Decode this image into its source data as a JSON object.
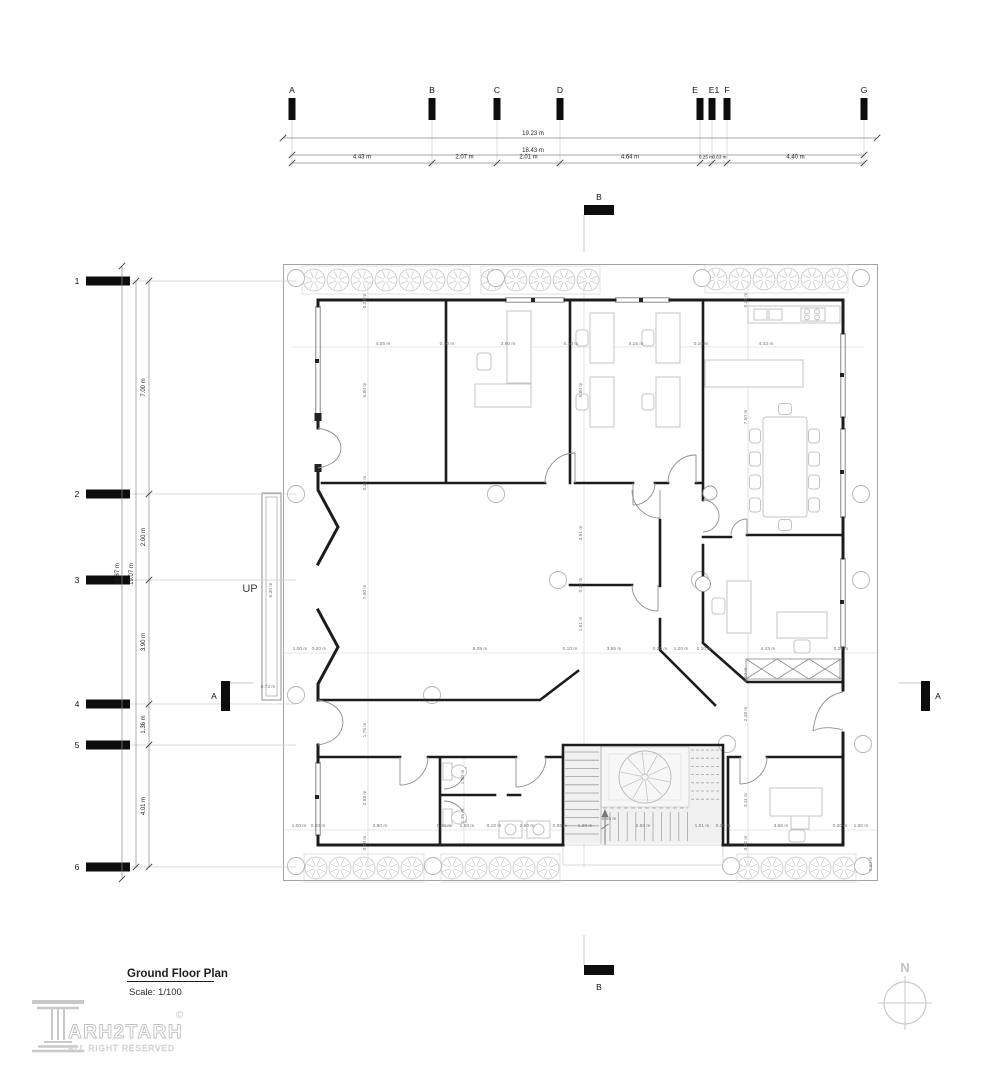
{
  "title_block": {
    "title": "Ground Floor Plan",
    "scale": "Scale: 1/100"
  },
  "logo": {
    "brand": "ARH2TARH",
    "registered": "©",
    "tagline": "ALL RIGHT RESERVED"
  },
  "compass": {
    "north": "N"
  },
  "labels": {
    "up": "UP",
    "section_a_left": "A",
    "section_a_right": "A",
    "section_b_top": "B",
    "section_b_bottom": "B"
  },
  "grid_top": {
    "letters": [
      {
        "label": "A",
        "x": 292
      },
      {
        "label": "B",
        "x": 432
      },
      {
        "label": "C",
        "x": 497
      },
      {
        "label": "D",
        "x": 560
      },
      {
        "label": "E",
        "x": 700,
        "lx": 695
      },
      {
        "label": "E1",
        "x": 712,
        "lx": 714
      },
      {
        "label": "F",
        "x": 727
      },
      {
        "label": "G",
        "x": 864
      }
    ],
    "totals": [
      {
        "label": "19.23 m",
        "x1": 283,
        "x2": 877,
        "y": 138,
        "tx": 533
      },
      {
        "label": "18.43 m",
        "x1": 292,
        "x2": 864,
        "y": 155,
        "tx": 533
      }
    ],
    "seg_y": 163,
    "segments": [
      {
        "label": "4.43 m",
        "x1": 292,
        "x2": 432
      },
      {
        "label": "2.07 m",
        "x1": 432,
        "x2": 497
      },
      {
        "label": "2.01 m",
        "x1": 497,
        "x2": 560
      },
      {
        "label": "4.64 m",
        "x1": 560,
        "x2": 700
      },
      {
        "label": "0.25 m",
        "x1": 700,
        "x2": 712
      },
      {
        "label": "0.63 m",
        "x1": 712,
        "x2": 727
      },
      {
        "label": "4.40 m",
        "x1": 727,
        "x2": 864
      }
    ]
  },
  "grid_left": {
    "numbers": [
      {
        "label": "1",
        "y": 281
      },
      {
        "label": "2",
        "y": 494
      },
      {
        "label": "3",
        "y": 580
      },
      {
        "label": "4",
        "y": 704
      },
      {
        "label": "5",
        "y": 745
      },
      {
        "label": "6",
        "y": 867
      }
    ],
    "totals": [
      {
        "label": "19.87 m",
        "x": 122,
        "y1": 266,
        "y2": 879,
        "ty": 574
      },
      {
        "label": "19.07 m",
        "x": 136,
        "y1": 281,
        "y2": 867,
        "ty": 574
      }
    ],
    "seg_x": 149,
    "segments": [
      {
        "label": "7.00 m",
        "y1": 281,
        "y2": 494
      },
      {
        "label": "2.00 m",
        "y1": 494,
        "y2": 580
      },
      {
        "label": "3.90 m",
        "y1": 580,
        "y2": 704
      },
      {
        "label": "1.36 m",
        "y1": 704,
        "y2": 745
      },
      {
        "label": "4.01 m",
        "y1": 745,
        "y2": 867
      }
    ]
  },
  "plan_dimensions": [
    {
      "t": "4.05 m",
      "x": 383,
      "y": 345
    },
    {
      "t": "0.10 m",
      "x": 447,
      "y": 345
    },
    {
      "t": "3.90 m",
      "x": 508,
      "y": 345
    },
    {
      "t": "0.10 m",
      "x": 571,
      "y": 345
    },
    {
      "t": "4.15 m",
      "x": 636,
      "y": 345
    },
    {
      "t": "0.10 m",
      "x": 701,
      "y": 345
    },
    {
      "t": "4.43 m",
      "x": 766,
      "y": 345
    },
    {
      "t": "1.00 m",
      "x": 300,
      "y": 650
    },
    {
      "t": "0.20 m",
      "x": 319,
      "y": 650
    },
    {
      "t": "8.05 m",
      "x": 480,
      "y": 650
    },
    {
      "t": "0.10 m",
      "x": 570,
      "y": 650
    },
    {
      "t": "3.95 m",
      "x": 614,
      "y": 650
    },
    {
      "t": "0.10 m",
      "x": 660,
      "y": 650
    },
    {
      "t": "1.20 m",
      "x": 681,
      "y": 650
    },
    {
      "t": "0.10 m",
      "x": 704,
      "y": 650
    },
    {
      "t": "4.43 m",
      "x": 768,
      "y": 650
    },
    {
      "t": "0.20 m",
      "x": 841,
      "y": 650
    },
    {
      "t": "1.00 m",
      "x": 299,
      "y": 827
    },
    {
      "t": "0.20 m",
      "x": 318,
      "y": 827
    },
    {
      "t": "3.90 m",
      "x": 380,
      "y": 827
    },
    {
      "t": "0.50 m",
      "x": 444,
      "y": 827
    },
    {
      "t": "1.50 m",
      "x": 467,
      "y": 827
    },
    {
      "t": "0.10 m",
      "x": 494,
      "y": 827
    },
    {
      "t": "2.90 m",
      "x": 527,
      "y": 827
    },
    {
      "t": "0.55 m",
      "x": 560,
      "y": 827
    },
    {
      "t": "1.20 m",
      "x": 585,
      "y": 827
    },
    {
      "t": "2.50 m",
      "x": 643,
      "y": 827
    },
    {
      "t": "0.05 m",
      "x": 609,
      "y": 820
    },
    {
      "t": "1.01 m",
      "x": 702,
      "y": 827
    },
    {
      "t": "0.10 m",
      "x": 723,
      "y": 827
    },
    {
      "t": "3.65 m",
      "x": 781,
      "y": 827
    },
    {
      "t": "0.20 m",
      "x": 840,
      "y": 827
    },
    {
      "t": "1.00 m",
      "x": 861,
      "y": 827
    },
    {
      "t": "0.20 m",
      "x": 366,
      "y": 301,
      "r": -90
    },
    {
      "t": "5.80 m",
      "x": 366,
      "y": 390,
      "r": -90
    },
    {
      "t": "0.10 m",
      "x": 366,
      "y": 483,
      "r": -90
    },
    {
      "t": "7.00 m",
      "x": 366,
      "y": 592,
      "r": -90
    },
    {
      "t": "1.75 m",
      "x": 366,
      "y": 730,
      "r": -90
    },
    {
      "t": "2.93 m",
      "x": 366,
      "y": 798,
      "r": -90
    },
    {
      "t": "0.20 m",
      "x": 366,
      "y": 843,
      "r": -90
    },
    {
      "t": "5.80 m",
      "x": 582,
      "y": 390,
      "r": -90
    },
    {
      "t": "3.91 m",
      "x": 582,
      "y": 533,
      "r": -90
    },
    {
      "t": "0.10 m",
      "x": 582,
      "y": 585,
      "r": -90
    },
    {
      "t": "1.61 m",
      "x": 582,
      "y": 624,
      "r": -90
    },
    {
      "t": "1.50 m",
      "x": 464,
      "y": 777,
      "r": -90
    },
    {
      "t": "1.45 m",
      "x": 464,
      "y": 816,
      "r": -90
    },
    {
      "t": "0.25 m",
      "x": 747,
      "y": 300,
      "r": -90
    },
    {
      "t": "7.50 m",
      "x": 747,
      "y": 417,
      "r": -90
    },
    {
      "t": "0.10 m",
      "x": 747,
      "y": 675,
      "r": -90
    },
    {
      "t": "2.48 m",
      "x": 747,
      "y": 714,
      "r": -90
    },
    {
      "t": "3.11 m",
      "x": 747,
      "y": 800,
      "r": -90
    },
    {
      "t": "0.22 m",
      "x": 747,
      "y": 843,
      "r": -90
    },
    {
      "t": "6.30 m",
      "x": 272,
      "y": 590,
      "r": -90
    },
    {
      "t": "0.73 m",
      "x": 268,
      "y": 688
    },
    {
      "t": "0.60 m",
      "x": 872,
      "y": 864,
      "r": -90
    }
  ],
  "colors": {
    "wall": "#1c1c1c",
    "window": "#7a7a7a",
    "light_gray": "#c2c2c2",
    "dim_text": "#6e6e6e",
    "site": "#9a9a9a"
  }
}
